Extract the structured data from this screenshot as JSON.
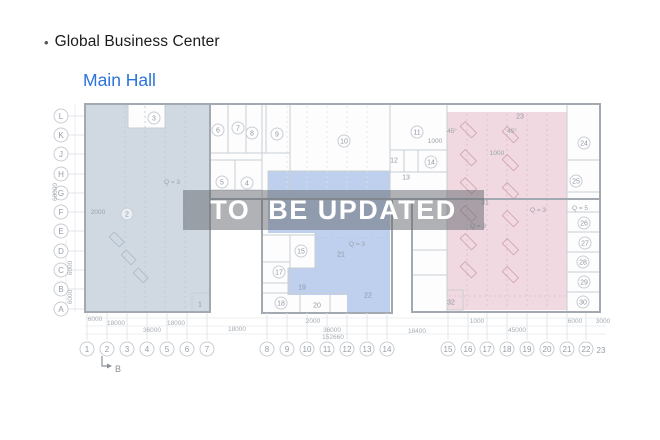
{
  "header": {
    "bullet": "•",
    "title": "Global Business Center"
  },
  "nav": {
    "hall_label": "Main Hall"
  },
  "watermark": {
    "text": "TO  BE UPDATED"
  },
  "colors": {
    "link": "#2b74da",
    "zone_left": "rgba(146,166,188,0.42)",
    "zone_center": "rgba(119,157,221,0.47)",
    "zone_right": "rgba(222,158,180,0.38)",
    "watermark_bg": "rgba(98,102,108,0.50)",
    "watermark_text": "#ffffff"
  },
  "plan": {
    "row_axis": [
      {
        "label": "L",
        "y": 116
      },
      {
        "label": "K",
        "y": 135
      },
      {
        "label": "J",
        "y": 154
      },
      {
        "label": "H",
        "y": 174
      },
      {
        "label": "G",
        "y": 193
      },
      {
        "label": "F",
        "y": 212
      },
      {
        "label": "E",
        "y": 231
      },
      {
        "label": "D",
        "y": 251
      },
      {
        "label": "C",
        "y": 270
      },
      {
        "label": "B",
        "y": 289
      },
      {
        "label": "A",
        "y": 309
      }
    ],
    "col_axis": [
      {
        "label": "1",
        "x": 87
      },
      {
        "label": "2",
        "x": 107
      },
      {
        "label": "3",
        "x": 127
      },
      {
        "label": "4",
        "x": 147
      },
      {
        "label": "5",
        "x": 167
      },
      {
        "label": "6",
        "x": 187
      },
      {
        "label": "7",
        "x": 207
      },
      {
        "label": "8",
        "x": 267
      },
      {
        "label": "9",
        "x": 287
      },
      {
        "label": "10",
        "x": 307
      },
      {
        "label": "11",
        "x": 327
      },
      {
        "label": "12",
        "x": 347
      },
      {
        "label": "13",
        "x": 367
      },
      {
        "label": "14",
        "x": 387
      },
      {
        "label": "15",
        "x": 448
      },
      {
        "label": "16",
        "x": 468
      },
      {
        "label": "17",
        "x": 487
      },
      {
        "label": "18",
        "x": 507
      },
      {
        "label": "19",
        "x": 527
      },
      {
        "label": "20",
        "x": 547
      },
      {
        "label": "21",
        "x": 567
      },
      {
        "label": "22",
        "x": 586
      },
      {
        "label": "23",
        "x": 601,
        "y": 353,
        "circled": false
      }
    ],
    "rooms": [
      {
        "n": "1",
        "x": 200,
        "y": 304,
        "c": false
      },
      {
        "n": "2",
        "x": 127,
        "y": 214,
        "c": true
      },
      {
        "n": "3",
        "x": 154,
        "y": 118,
        "c": true
      },
      {
        "n": "4",
        "x": 247,
        "y": 183,
        "c": true
      },
      {
        "n": "5",
        "x": 222,
        "y": 182,
        "c": true
      },
      {
        "n": "6",
        "x": 218,
        "y": 130,
        "c": true
      },
      {
        "n": "7",
        "x": 238,
        "y": 128,
        "c": true
      },
      {
        "n": "8",
        "x": 252,
        "y": 133,
        "c": true
      },
      {
        "n": "9",
        "x": 277,
        "y": 134,
        "c": true
      },
      {
        "n": "10",
        "x": 344,
        "y": 141,
        "c": true
      },
      {
        "n": "11",
        "x": 417,
        "y": 132,
        "c": true
      },
      {
        "n": "12",
        "x": 394,
        "y": 160,
        "c": false
      },
      {
        "n": "13",
        "x": 406,
        "y": 177,
        "c": false
      },
      {
        "n": "14",
        "x": 431,
        "y": 162,
        "c": true
      },
      {
        "n": "15",
        "x": 301,
        "y": 251,
        "c": true
      },
      {
        "n": "17",
        "x": 279,
        "y": 272,
        "c": true
      },
      {
        "n": "18",
        "x": 281,
        "y": 303,
        "c": true
      },
      {
        "n": "19",
        "x": 302,
        "y": 287,
        "c": false
      },
      {
        "n": "20",
        "x": 317,
        "y": 305,
        "c": false
      },
      {
        "n": "21",
        "x": 341,
        "y": 254,
        "c": false
      },
      {
        "n": "22",
        "x": 368,
        "y": 295,
        "c": false
      },
      {
        "n": "23",
        "x": 520,
        "y": 116,
        "c": false
      },
      {
        "n": "24",
        "x": 584,
        "y": 143,
        "c": true
      },
      {
        "n": "25",
        "x": 576,
        "y": 181,
        "c": true
      },
      {
        "n": "26",
        "x": 584,
        "y": 223,
        "c": true
      },
      {
        "n": "27",
        "x": 585,
        "y": 243,
        "c": true
      },
      {
        "n": "28",
        "x": 583,
        "y": 262,
        "c": true
      },
      {
        "n": "29",
        "x": 584,
        "y": 282,
        "c": true
      },
      {
        "n": "30",
        "x": 583,
        "y": 302,
        "c": true
      },
      {
        "n": "31",
        "x": 485,
        "y": 202,
        "c": false
      },
      {
        "n": "32",
        "x": 451,
        "y": 302,
        "c": false
      }
    ],
    "annotations": [
      {
        "t": "Q = 3",
        "x": 172,
        "y": 184
      },
      {
        "t": "Q = 3",
        "x": 357,
        "y": 246
      },
      {
        "t": "Q = 3",
        "x": 478,
        "y": 228
      },
      {
        "t": "Q = 3",
        "x": 538,
        "y": 212
      },
      {
        "t": "Q = 5",
        "x": 580,
        "y": 210
      },
      {
        "t": "45°",
        "x": 452,
        "y": 133
      },
      {
        "t": "45°",
        "x": 512,
        "y": 133
      },
      {
        "t": "1000",
        "x": 435,
        "y": 143
      },
      {
        "t": "1000",
        "x": 497,
        "y": 155
      },
      {
        "t": "2000",
        "x": 98,
        "y": 214
      }
    ],
    "dims_bottom": [
      {
        "t": "6000",
        "x": 95,
        "y": 321
      },
      {
        "t": "18000",
        "x": 116,
        "y": 325
      },
      {
        "t": "18000",
        "x": 176,
        "y": 325
      },
      {
        "t": "36000",
        "x": 152,
        "y": 332
      },
      {
        "t": "18000",
        "x": 237,
        "y": 331
      },
      {
        "t": "2000",
        "x": 313,
        "y": 323
      },
      {
        "t": "36000",
        "x": 332,
        "y": 332
      },
      {
        "t": "152660",
        "x": 333,
        "y": 339
      },
      {
        "t": "18400",
        "x": 417,
        "y": 333
      },
      {
        "t": "1000",
        "x": 477,
        "y": 323
      },
      {
        "t": "45000",
        "x": 517,
        "y": 332
      },
      {
        "t": "6000",
        "x": 575,
        "y": 323
      },
      {
        "t": "3000",
        "x": 603,
        "y": 323
      }
    ],
    "dims_left": [
      {
        "t": "60000",
        "x": 57,
        "y": 192,
        "rot": true
      },
      {
        "t": "6000",
        "x": 72,
        "y": 268,
        "rot": true
      },
      {
        "t": "6000",
        "x": 72,
        "y": 297,
        "rot": true
      }
    ],
    "marker_b": {
      "label": "B",
      "x": 115,
      "y": 372
    }
  }
}
